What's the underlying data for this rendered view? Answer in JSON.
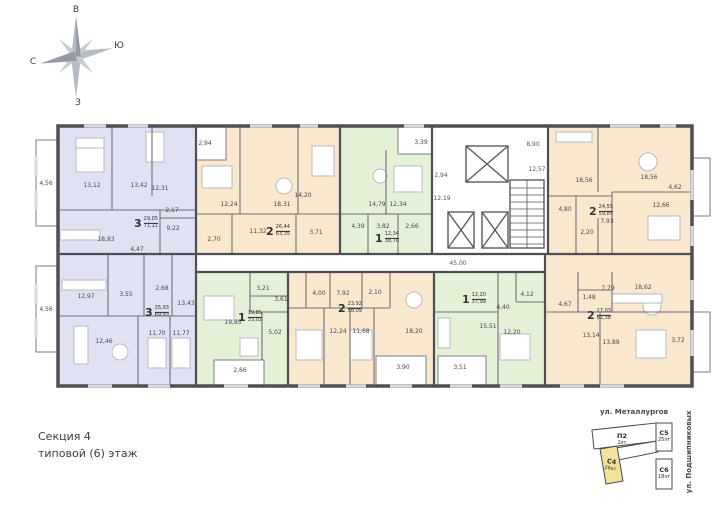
{
  "compass": {
    "top": "В",
    "right": "Ю",
    "left": "С",
    "bottom": "З"
  },
  "plan": {
    "corridor_label": "45,00",
    "core": {
      "hall_top": "8,90",
      "hall_right": "12,57",
      "lobby": "2,94",
      "hall_left": "12,19"
    },
    "apartments": [
      {
        "name": "3-room top-left",
        "type": "3",
        "area_live": "29,05",
        "area_total": "71,11",
        "color": "#e1e1f4",
        "rooms": [
          "4,56",
          "13,12",
          "13,42",
          "12,31",
          "2,17",
          "9,22",
          "18,83",
          "4,47"
        ]
      },
      {
        "name": "2-room top-middle",
        "type": "2",
        "area_live": "26,44",
        "area_total": "63,35",
        "color": "#f9e8cd",
        "rooms": [
          "2,94",
          "12,24",
          "18,31",
          "14,20",
          "11,32",
          "2,70",
          "3,71"
        ]
      },
      {
        "name": "1-room top-middle",
        "type": "1",
        "area_live": "12,34",
        "area_total": "38,70",
        "color": "#e4f1d7",
        "rooms": [
          "3,39",
          "14,79",
          "12,34",
          "4,39",
          "3,82",
          "2,66"
        ]
      },
      {
        "name": "2-room top-right",
        "type": "2",
        "area_live": "24,55",
        "area_total": "59,85",
        "color": "#f9e8cd",
        "rooms": [
          "11,89",
          "18,56",
          "4,62",
          "12,66",
          "4,80",
          "7,93",
          "2,20"
        ]
      },
      {
        "name": "3-room bottom-left",
        "type": "3",
        "area_live": "35,93",
        "area_total": "69,93",
        "color": "#e1e1f4",
        "rooms": [
          "4,56",
          "12,97",
          "3,55",
          "2,68",
          "13,43",
          "12,46",
          "11,70",
          "11,77"
        ]
      },
      {
        "name": "1-room bottom-middle",
        "type": "1",
        "area_live": "19,85",
        "area_total": "33,02",
        "color": "#e4f1d7",
        "rooms": [
          "3,21",
          "3,61",
          "19,85",
          "5,02",
          "2,66"
        ]
      },
      {
        "name": "2-room bottom-middle",
        "type": "2",
        "area_live": "23,92",
        "area_total": "58,09",
        "color": "#f9e8cd",
        "rooms": [
          "4,00",
          "7,92",
          "2,10",
          "12,24",
          "11,68",
          "18,20",
          "3,90"
        ]
      },
      {
        "name": "1-room bottom-right",
        "type": "1",
        "area_live": "12,20",
        "area_total": "37,99",
        "color": "#e4f1d7",
        "rooms": [
          "4,12",
          "4,40",
          "15,51",
          "12,20",
          "3,51"
        ]
      },
      {
        "name": "2-room bottom-right",
        "type": "2",
        "area_live": "27,03",
        "area_total": "61,38",
        "color": "#f9e8cd",
        "rooms": [
          "18,62",
          "7,79",
          "1,48",
          "4,67",
          "13,14",
          "13,89",
          "3,72"
        ]
      }
    ]
  },
  "footer": {
    "section": "Секция 4",
    "floor": "типовой (6) этаж"
  },
  "keyplan": {
    "street_top": "ул. Металлургов",
    "street_right": "ул. Подшипниковых",
    "highlight_color": "#f1e39b",
    "buildings": [
      {
        "label": "П2",
        "floors": "2эт",
        "highlighted": false
      },
      {
        "label": "С5",
        "floors": "25эт",
        "highlighted": false
      },
      {
        "label": "С4",
        "floors": "26эт",
        "highlighted": true
      },
      {
        "label": "С6",
        "floors": "18эт",
        "highlighted": false
      }
    ]
  }
}
